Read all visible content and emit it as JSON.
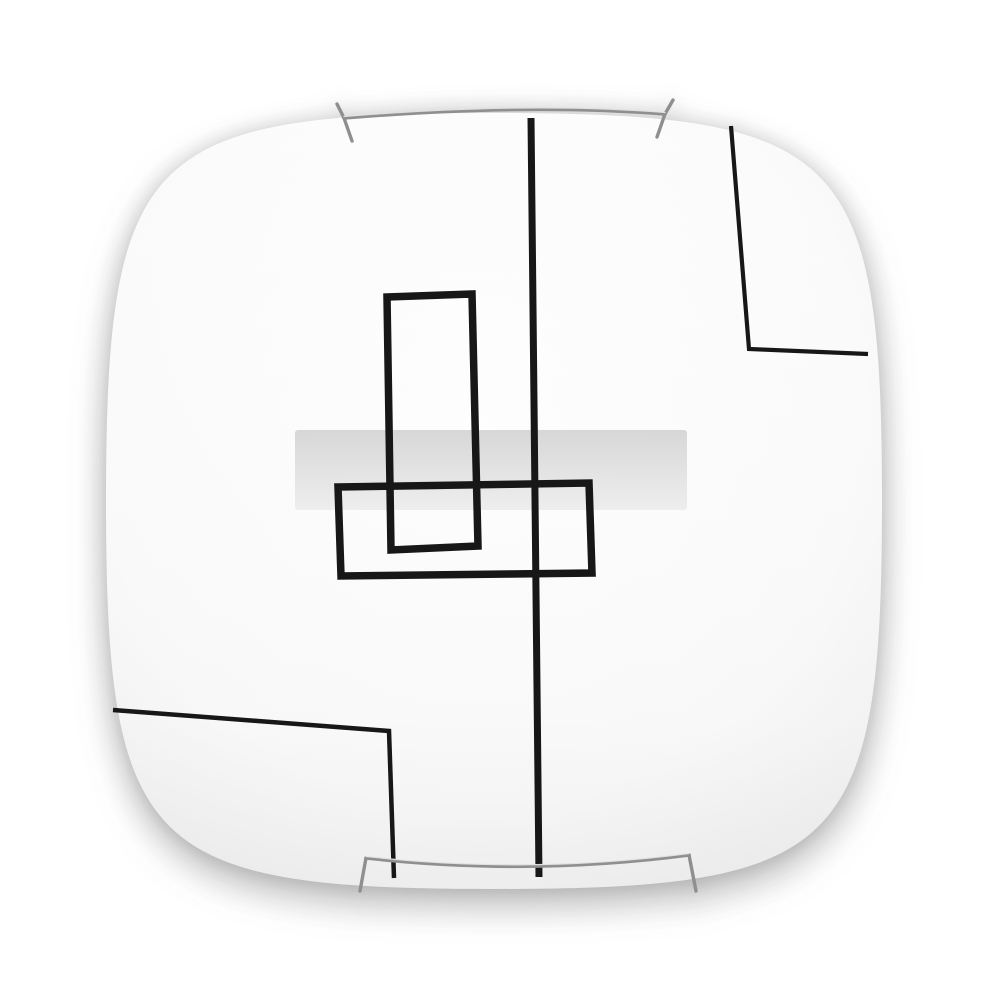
{
  "meta": {
    "domain": "natural-image",
    "description": "Product photograph of a square frosted-glass ceiling light fixture with black geometric line decoration, a translucent frosted band across the middle, and two chrome wire mounting clips, shown on a plain white background with a soft shadow"
  },
  "colors": {
    "background": "#ffffff",
    "glass_center": "#ffffff",
    "glass_mid": "#fbfbfb",
    "glass_edge": "#eeeeee",
    "glass_shade": "#9a9a9a",
    "decor_line": "#171717",
    "band_top": "#d2d2d2",
    "band_mid": "#dfdfdf",
    "band_bottom": "#ececec",
    "clip_wire": "#8f8f8f",
    "clip_highlight": "#e8e8e8"
  },
  "elements": {
    "plate": "square glass diffuser",
    "band": "frosted horizontal band",
    "center_line": "central vertical decor line",
    "tall_rect": "tall rectangle outline",
    "wide_rect": "wide rectangle outline",
    "top_right_line": "top-right corner L-shaped line",
    "bottom_left_line": "bottom-left corner L-shaped line",
    "top_clip": "top chrome mounting clip",
    "bottom_clip": "bottom chrome mounting clip"
  }
}
